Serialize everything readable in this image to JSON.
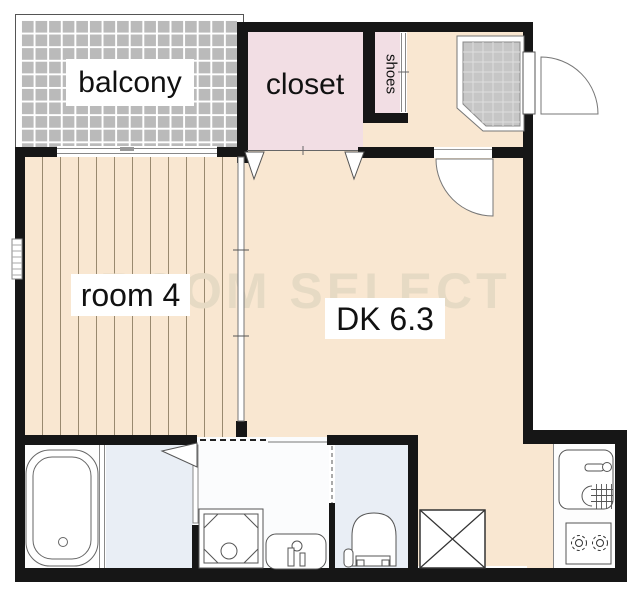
{
  "labels": {
    "balcony": "balcony",
    "closet": "closet",
    "shoes": "shoes",
    "room4": "room 4",
    "dk": "DK 6.3"
  },
  "watermark": "ROOM SELECT",
  "colors": {
    "wall": "#161616",
    "floor": "#f9e7d1",
    "plank": "#99896f",
    "closet": "#f2dee4",
    "wet": "#e9eef5",
    "bath": "#fdfdfd",
    "balcony": "#bababa",
    "tile": "#c6c6c6",
    "outline": "#555555",
    "watermark": "#e6dac4"
  },
  "areas": [
    "balcony",
    "closet",
    "shoes",
    "entry",
    "room4",
    "dining-kitchen",
    "bathroom",
    "washroom",
    "toilet",
    "kitchen"
  ],
  "fixtures": [
    "bathtub",
    "washing-machine-pan",
    "vanity-sink",
    "toilet",
    "refrigerator-space",
    "kitchen-sink",
    "gas-stove",
    "entry-door",
    "interior-door",
    "washroom-door",
    "closet-folding-doors",
    "sliding-partition",
    "balcony-window",
    "side-window",
    "shoes-sliding-door",
    "genkan-tile"
  ]
}
